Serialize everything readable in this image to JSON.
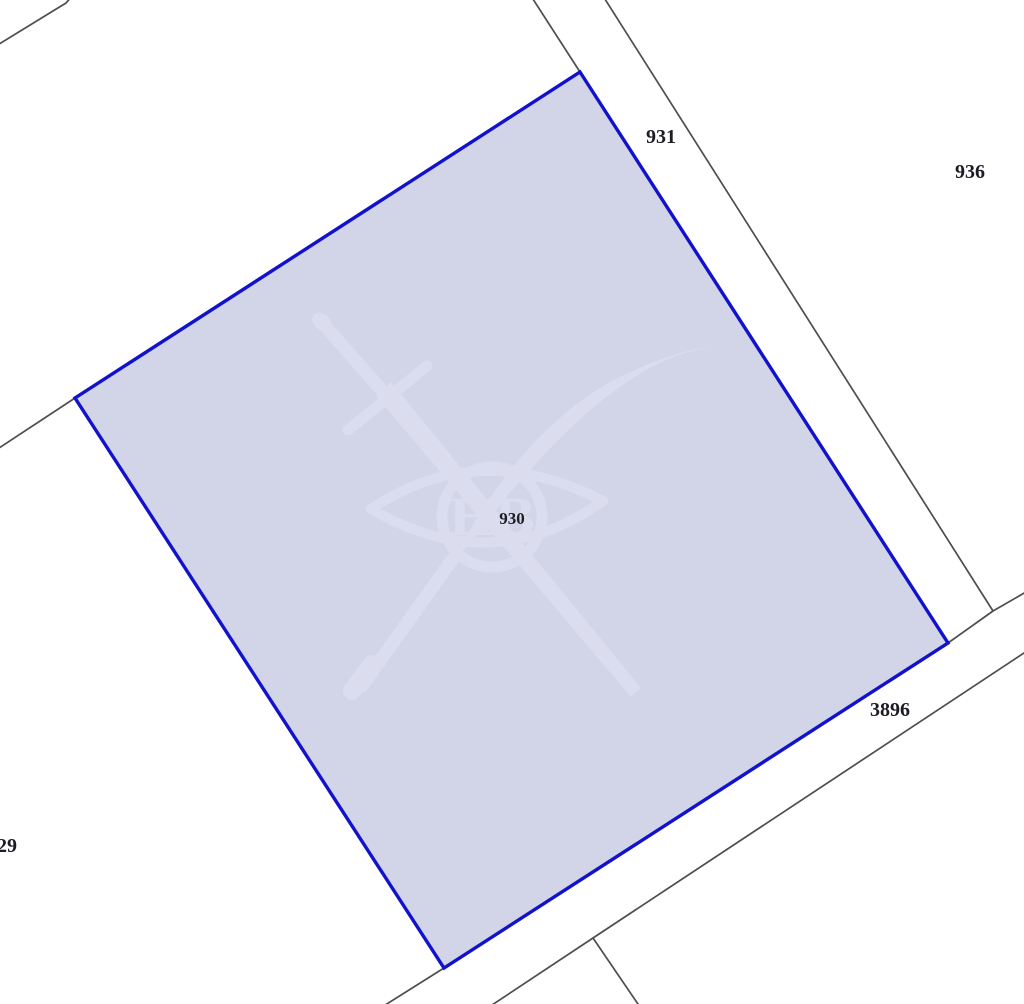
{
  "map": {
    "selected_parcel": {
      "label": "930",
      "fill_color": "#d2d4e8",
      "border_color": "#1212cc"
    },
    "neighbors": {
      "parcel_right_strip": "931",
      "parcel_far_right": "936",
      "road_bottom": "3896",
      "parcel_bottom_left_partial": "29"
    },
    "watermark": {
      "monogram": "НВ"
    },
    "colors": {
      "background": "#ffffff",
      "boundary_lines": "#4d4d4d",
      "label_text": "#1c1c24",
      "watermark_tint": "#dbddee"
    }
  }
}
